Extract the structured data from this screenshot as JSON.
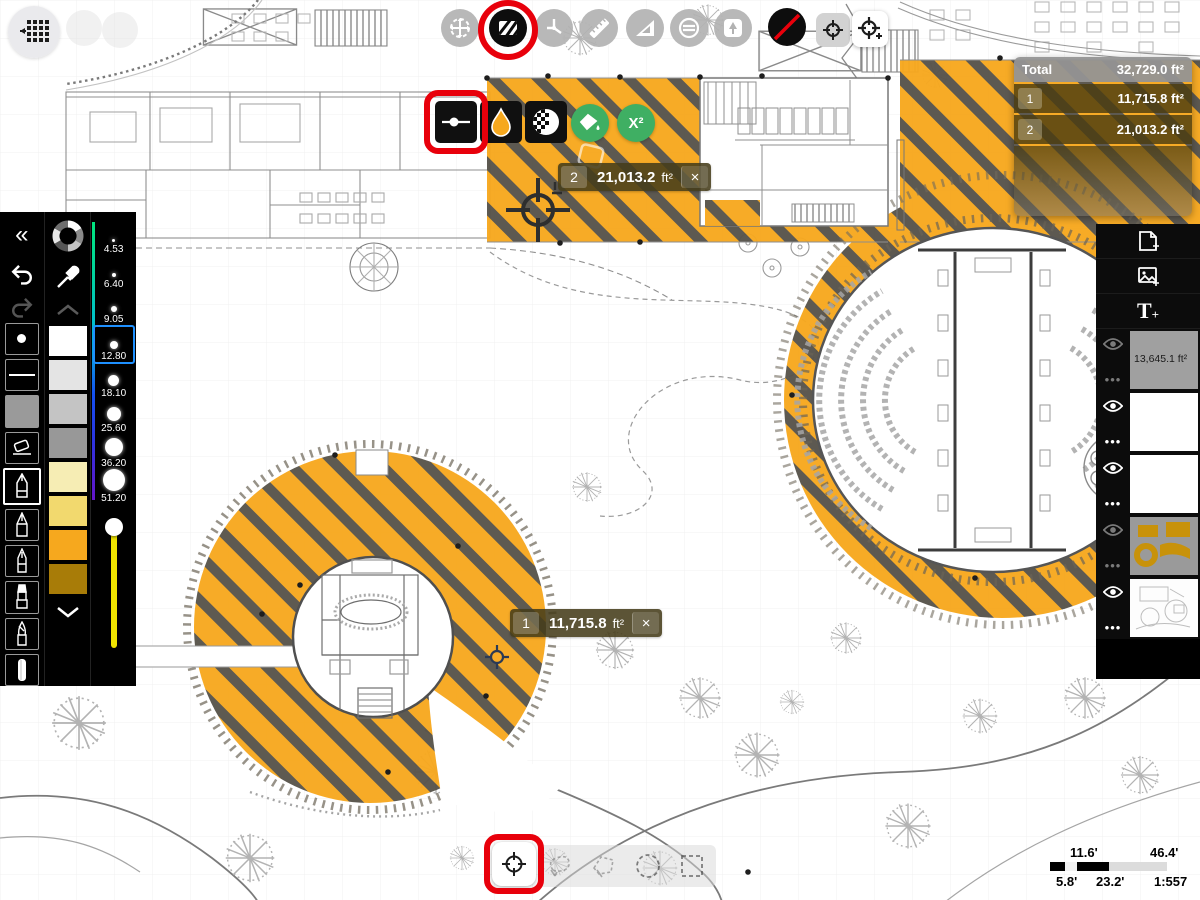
{
  "app": {
    "name": "Trace area measure"
  },
  "top_toolbar": {
    "icons": [
      "apps-grid-icon",
      "move-tool-icon",
      "hatch-fill-tool-icon",
      "protractor-tool-icon",
      "ruler-tool-icon",
      "set-square-tool-icon",
      "stencil-tool-icon",
      "tree-stamp-tool-icon",
      "no-color-tool-icon",
      "area-marker-icon",
      "area-marker-add-icon"
    ]
  },
  "sub_toolbar": {
    "icons": [
      "stroke-weight-icon",
      "color-droplet-icon",
      "texture-opacity-icon",
      "fill-bucket-icon",
      "area-calc-button"
    ],
    "area_calc_label": "X²"
  },
  "measurement_labels": {
    "label_1": {
      "id": "1",
      "value": "11,715.8",
      "unit": "ft²",
      "close": "×"
    },
    "label_2": {
      "id": "2",
      "value": "21,013.2",
      "unit": "ft²",
      "close": "×"
    }
  },
  "totals_panel": {
    "title": "Total",
    "total_value": "32,729.0 ft²",
    "rows": [
      {
        "id": "1",
        "value": "11,715.8 ft²"
      },
      {
        "id": "2",
        "value": "21,013.2 ft²"
      }
    ]
  },
  "left_panel": {
    "collapse_label": "«",
    "brush_sizes": [
      {
        "label": "4.53"
      },
      {
        "label": "6.40"
      },
      {
        "label": "9.05"
      },
      {
        "label": "12.80"
      },
      {
        "label": "18.10"
      },
      {
        "label": "25.60"
      },
      {
        "label": "36.20"
      },
      {
        "label": "51.20"
      }
    ],
    "selected_size": "12.80",
    "swatches": [
      "#ffffff",
      "#e4e4e4",
      "#c4c4c4",
      "#989898",
      "#f6edb4",
      "#f2d96e",
      "#f6a81e",
      "#a87c08"
    ],
    "tools": [
      "dot-brush",
      "line-brush",
      "gray-fill",
      "eraser",
      "pen",
      "pencil",
      "fine-pen",
      "marker",
      "brush",
      "paint-stick"
    ]
  },
  "right_panel": {
    "buttons": [
      "new-page",
      "add-image",
      "add-text"
    ],
    "text_tool_label": "T",
    "text_tool_plus": "+",
    "layers": [
      {
        "label": "13,645.1 ft²"
      },
      {
        "label": ""
      },
      {
        "label": ""
      },
      {
        "label": ""
      },
      {
        "label": ""
      }
    ]
  },
  "bottom_toolbar": {
    "icons": [
      "crosshair-select-icon",
      "freehand-lasso-icon",
      "polyline-lasso-icon",
      "circle-select-icon",
      "rectangle-select-icon"
    ]
  },
  "scale_widget": {
    "top_left": "11.6'",
    "top_right": "46.4'",
    "bottom_left": "5.8'",
    "bottom_mid": "23.2'",
    "ratio": "1:557"
  },
  "colors": {
    "hatch_yellow": "#F7A81E",
    "hatch_stripe": "#57534A",
    "accent_red": "#E8000B",
    "accent_green": "#3FAF63",
    "selection_blue": "#1E90FF",
    "slider_yellow": "#F0E400",
    "label_olive": "#4A3E1C"
  }
}
